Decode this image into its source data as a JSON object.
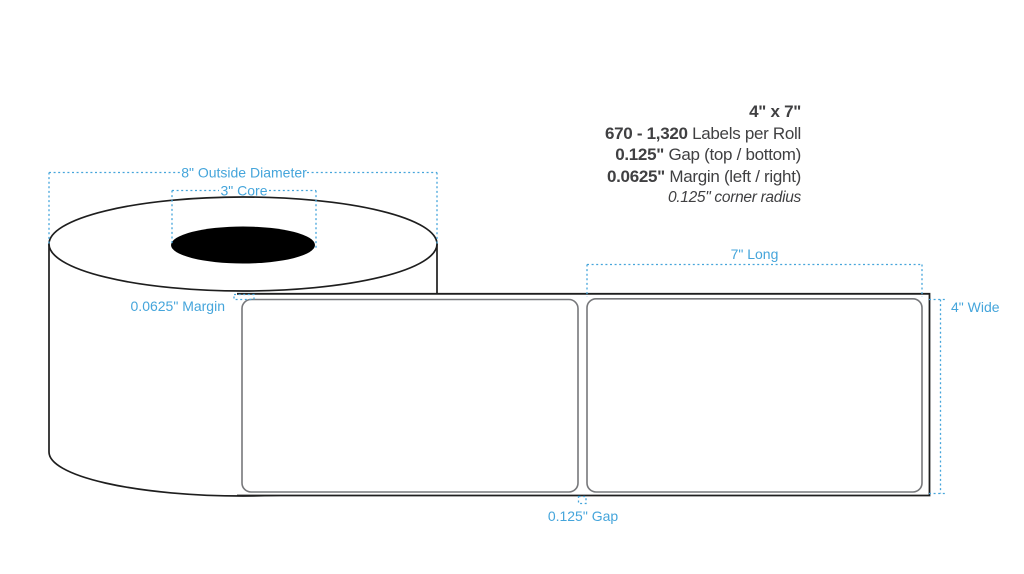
{
  "specs": {
    "size": "4\" x 7\"",
    "labels_per_roll_value": "670 - 1,320",
    "labels_per_roll_label": " Labels per Roll",
    "gap_value": "0.125\"",
    "gap_label": " Gap (top / bottom)",
    "margin_value": "0.0625\"",
    "margin_label": " Margin (left / right)",
    "corner_radius_note": "0.125\" corner radius"
  },
  "diagram": {
    "outside_diameter_label": "8\" Outside Diameter",
    "core_label": "3\" Core",
    "margin_label": "0.0625\" Margin",
    "length_label": "7\" Long",
    "width_label": "4\" Wide",
    "gap_label": "0.125\" Gap"
  },
  "colors": {
    "annotation_blue": "#45A5DB",
    "spec_text_dark": "#404042",
    "label_outline_gray": "#77787B",
    "diagram_outline_black": "#1E1E1E",
    "core_fill": "#000000"
  }
}
